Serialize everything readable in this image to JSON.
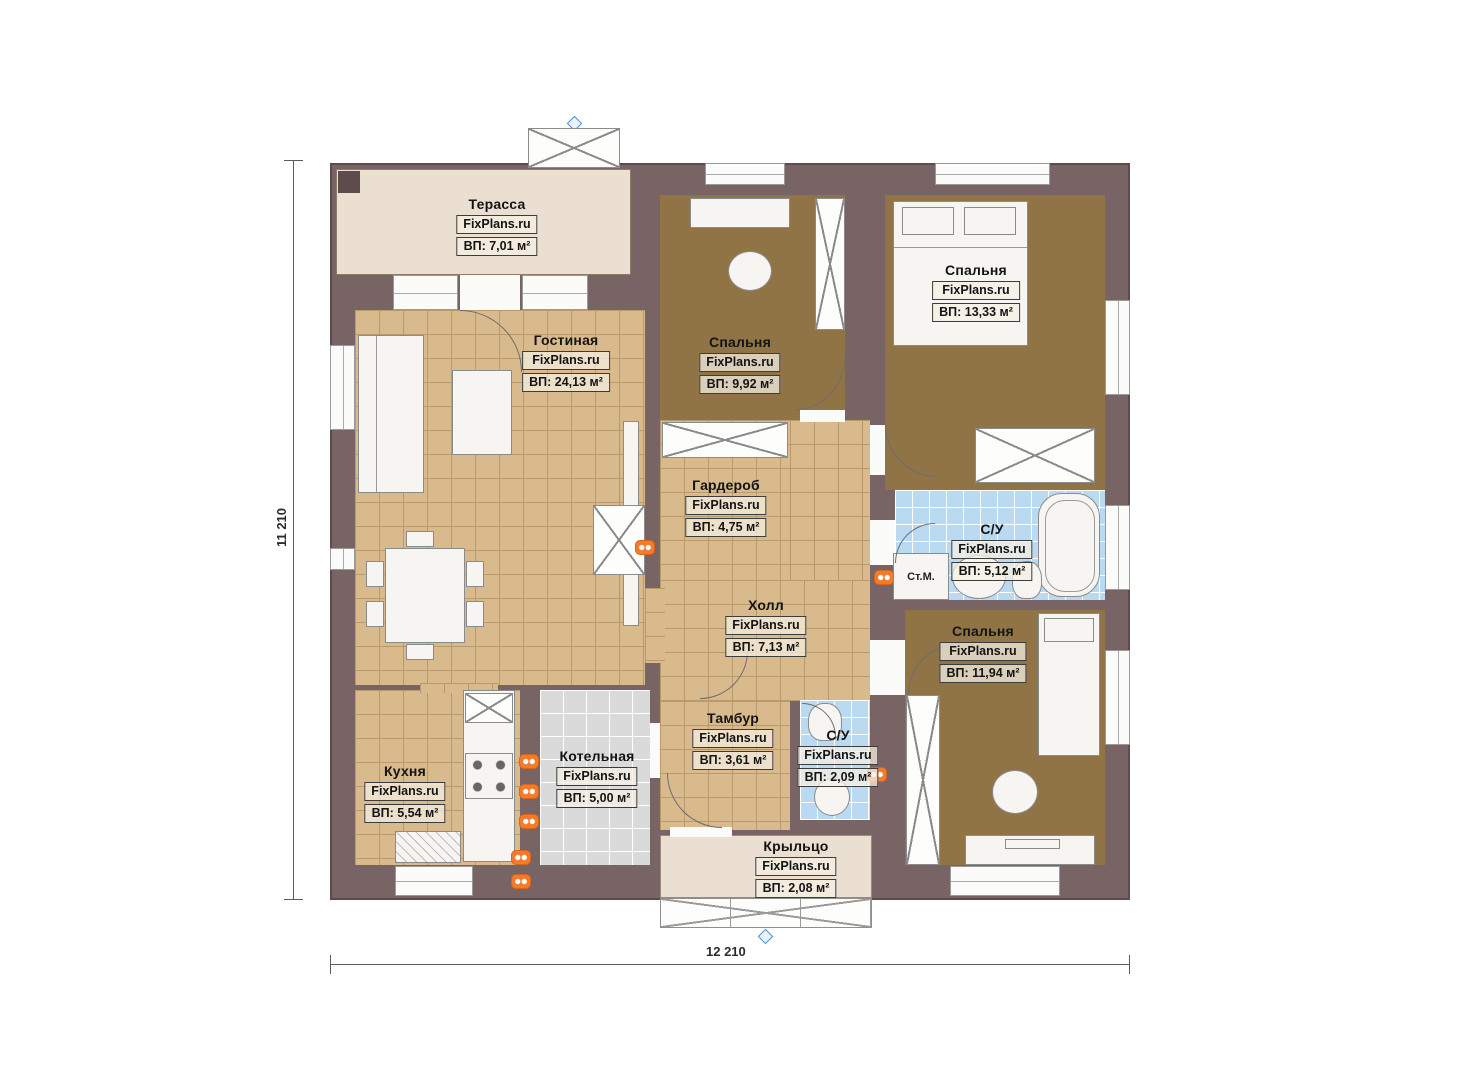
{
  "plan": {
    "watermark": "FixPlans.ru",
    "dimensions": {
      "height_label": "11 210",
      "width_label": "12 210"
    },
    "appliance_labels": {
      "washing_machine": "Ст.М."
    },
    "rooms": [
      {
        "id": "terrace",
        "name": "Терасса",
        "area": "ВП: 7,01 м²"
      },
      {
        "id": "living",
        "name": "Гостиная",
        "area": "ВП: 24,13 м²"
      },
      {
        "id": "bedroom1",
        "name": "Спальня",
        "area": "ВП: 9,92 м²"
      },
      {
        "id": "bedroom2",
        "name": "Спальня",
        "area": "ВП: 13,33 м²"
      },
      {
        "id": "wardrobe",
        "name": "Гардероб",
        "area": "ВП: 4,75 м²"
      },
      {
        "id": "hall",
        "name": "Холл",
        "area": "ВП: 7,13 м²"
      },
      {
        "id": "bath1",
        "name": "С/У",
        "area": "ВП: 5,12 м²"
      },
      {
        "id": "bedroom3",
        "name": "Спальня",
        "area": "ВП: 11,94 м²"
      },
      {
        "id": "kitchen",
        "name": "Кухня",
        "area": "ВП: 5,54 м²"
      },
      {
        "id": "boiler",
        "name": "Котельная",
        "area": "ВП: 5,00 м²"
      },
      {
        "id": "tambur",
        "name": "Тамбур",
        "area": "ВП: 3,61 м²"
      },
      {
        "id": "bath2",
        "name": "С/У",
        "area": "ВП: 2,09 м²"
      },
      {
        "id": "porch",
        "name": "Крыльцо",
        "area": "ВП: 2,08 м²"
      }
    ],
    "colors": {
      "wall": "#786365",
      "floor_wood": "#d9ba8d",
      "floor_carpet": "#917446",
      "tile_blue": "#b9daf1",
      "tile_gray": "#dadada",
      "terrace_floor": "#eadfd1",
      "radiator_orange": "#f37b2a",
      "marker_blue": "#4a90d9"
    }
  }
}
